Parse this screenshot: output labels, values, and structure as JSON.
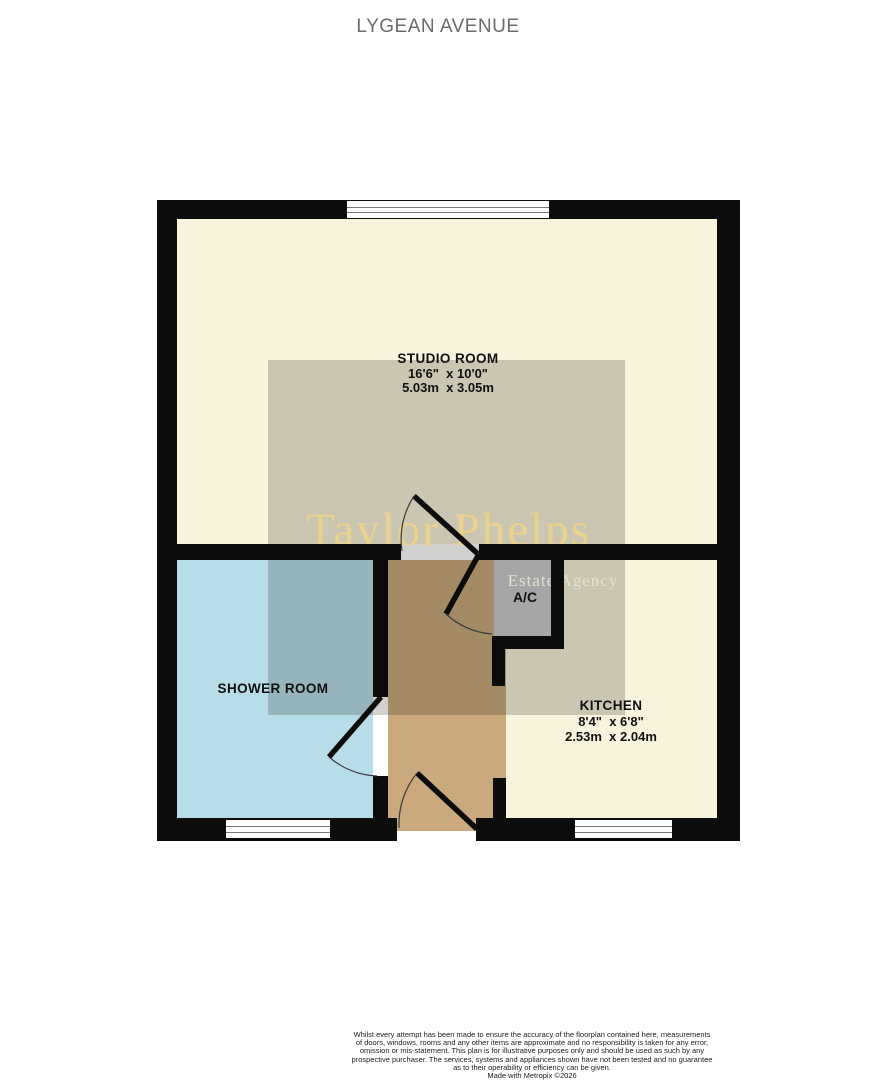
{
  "page": {
    "title": "LYGEAN AVENUE"
  },
  "watermark": {
    "name": "Taylor Phelps",
    "tagline": "Estate Agency"
  },
  "rooms": {
    "studio": {
      "name": "STUDIO ROOM",
      "size_imperial": "16'6\"  x 10'0\"",
      "size_metric": "5.03m  x 3.05m"
    },
    "shower": {
      "name": "SHOWER ROOM"
    },
    "kitchen": {
      "name": "KITCHEN",
      "size_imperial": "8'4\"  x 6'8\"",
      "size_metric": "2.53m  x 2.04m"
    },
    "cupboard": {
      "name": "A/C"
    }
  },
  "disclaimer": {
    "lines": [
      "Whilst every attempt has been made to ensure the accuracy of the floorplan contained here, measurements",
      "of doors, windows, rooms and any other items are approximate and no responsibility is taken for any error,",
      "omission or mis-statement. This plan is for illustrative purposes only and should be used as such by any",
      "prospective purchaser. The services, systems and appliances shown have not been tested and no guarantee",
      "as to their operability or efficiency can be given.",
      "Made with Metropix ©2026"
    ]
  },
  "colors": {
    "room_cream": "#f8f3dd",
    "shower_blue": "#b7dde8",
    "hallway_tan": "#c9a97d",
    "cupboard_gray": "#a6a6a6",
    "wall_black": "#0c0c0c",
    "watermark_gold": "#f0d488",
    "watermark_light": "#e6e5d3",
    "title_gray": "#6b6b6b"
  }
}
